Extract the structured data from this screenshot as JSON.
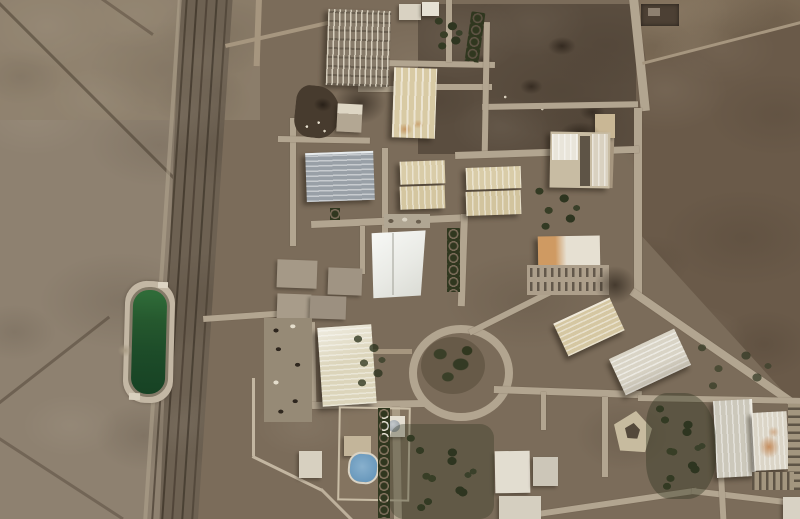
{
  "scene": {
    "type": "satellite-photo",
    "description": "Overhead satellite view of a desert industrial complex: a railway corridor and highway cross barren brown terrain on the left, a rectangular green water reservoir sits beside the tracks, and a fenced facility with beige warehouses, a bright white hall, a gray ribbed warehouse, a traffic roundabout with dark vegetation, tree stands, parking lots and perimeter roads spreads across the right.",
    "terrain": "arid desert, mottled brown",
    "notable_features": [
      "green-water-reservoir",
      "railway-corridor",
      "white-tent-hall",
      "gray-ribbed-warehouse",
      "beige-warehouse-rows",
      "demolished-rubble-patch",
      "electrical-substation-racks",
      "traffic-roundabout",
      "pentagon-building-with-courtyard",
      "rust-stained-warehouse",
      "tree-groves",
      "perimeter-fence-roads",
      "walled-compound-with-blue-pool"
    ]
  },
  "palette": {
    "desert_left": "#8e8170",
    "desert_light": "#97896f",
    "rail_corridor": "#6d6152",
    "facility_ground": "#7b6c5a",
    "dark_plot": "#574a3c",
    "dark_field_right": "#6a5a49",
    "road": "#b2a590",
    "reservoir_pad": "#c3b7a4",
    "reservoir_water": "#1d4c29",
    "white_hall": "#f0f1ed",
    "beige_building": "#d8caa3",
    "gray_building": "#99a0a7",
    "vegetation": "#343a24",
    "rust_stain": "#c08449"
  }
}
